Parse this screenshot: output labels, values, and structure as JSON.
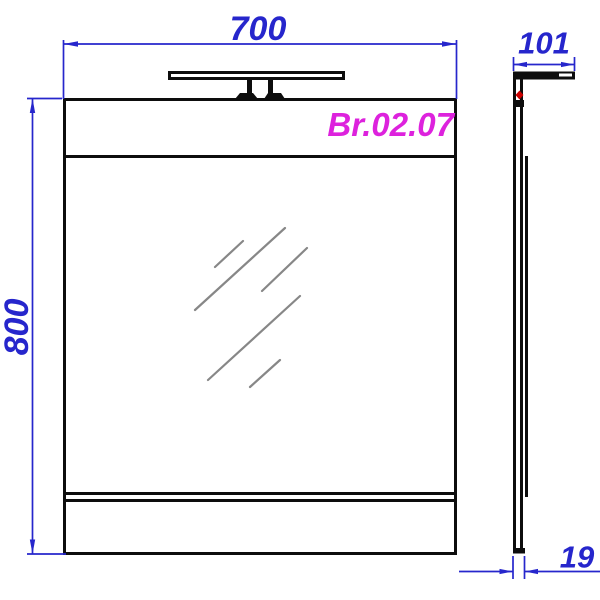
{
  "drawing": {
    "model_code": "Br.02.07",
    "dimensions": {
      "width": "700",
      "height": "800",
      "depth": "101",
      "thickness": "19"
    },
    "colors": {
      "outline_black": "#0d0d0d",
      "dimension_blue": "#2626cc",
      "model_label_magenta": "#dd22dd",
      "mirror_hatch_gray": "#878787",
      "marker_red": "#cc0000",
      "background": "#ffffff"
    }
  }
}
